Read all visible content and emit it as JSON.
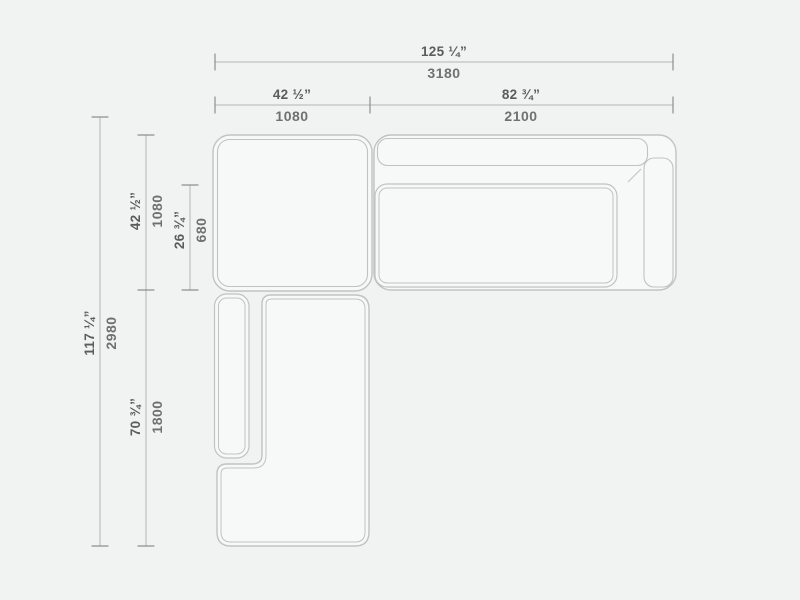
{
  "title": "sectional-sofa-dimension-drawing",
  "colors": {
    "background": "#f1f2f2",
    "module_fill": "#f7f8f8",
    "outline": "#c2c2c2",
    "dim_line": "#b4b4b4",
    "tick": "#8e8e8e",
    "label_inches": "#5c5c5c",
    "label_mm": "#707070"
  },
  "dims": {
    "total_width": {
      "inches": "125 ¼”",
      "mm": "3180"
    },
    "left_module_width": {
      "inches": "42 ½”",
      "mm": "1080"
    },
    "right_module_width": {
      "inches": "82 ¾”",
      "mm": "2100"
    },
    "total_depth": {
      "inches": "117 ¼”",
      "mm": "2980"
    },
    "left_module_depth": {
      "inches": "42 ½”",
      "mm": "1080"
    },
    "seat_depth": {
      "inches": "26 ¾”",
      "mm": "680"
    },
    "chaise_depth": {
      "inches": "70 ¾”",
      "mm": "1800"
    }
  }
}
